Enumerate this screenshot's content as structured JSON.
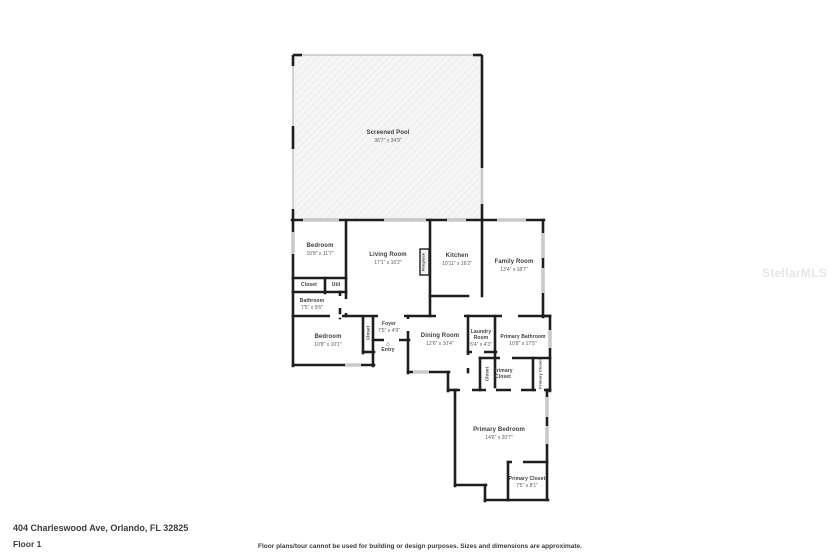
{
  "watermark": "StellarMLS",
  "footer": {
    "address": "404 Charleswood Ave, Orlando, FL 32825",
    "floor_label": "Floor 1",
    "disclaimer": "Floor plans/tour cannot be used for building or design purposes. Sizes and dimensions are approximate."
  },
  "entry_arrow": "△",
  "rooms": {
    "screened_pool": {
      "name": "Screened Pool",
      "dims": "36'7\" x 34'9\""
    },
    "bedroom1": {
      "name": "Bedroom",
      "dims": "10'8\" x 11'7\""
    },
    "living_room": {
      "name": "Living Room",
      "dims": "17'1\" x 16'2\""
    },
    "kitchen": {
      "name": "Kitchen",
      "dims": "10'11\" x 16'2\""
    },
    "family_room": {
      "name": "Family Room",
      "dims": "13'4\" x 18'7\""
    },
    "closet_hall": {
      "name": "Closet"
    },
    "util": {
      "name": "Util"
    },
    "bathroom": {
      "name": "Bathroom",
      "dims": "7'5\" x 9'6\""
    },
    "bedroom2": {
      "name": "Bedroom",
      "dims": "10'8\" x 10'1\""
    },
    "closet_bedroom2": {
      "name": "Closet"
    },
    "foyer": {
      "name": "Foyer",
      "dims": "7'5\" x 4'9\""
    },
    "entry": {
      "name": "Entry"
    },
    "dining_room": {
      "name": "Dining Room",
      "dims": "12'6\" x 10'4\""
    },
    "laundry_room": {
      "name": "Laundry Room",
      "dims": "5'4\" x 4'3\""
    },
    "primary_bathroom": {
      "name": "Primary Bathroom",
      "dims": "10'8\" x 17'5\""
    },
    "closet_hall2": {
      "name": "Closet"
    },
    "primary_closet_a": {
      "name": "Primary Closet"
    },
    "primary_closet_b": {
      "name": "Primary Closet"
    },
    "primary_bedroom": {
      "name": "Primary Bedroom",
      "dims": "14'6\" x 20'7\""
    },
    "primary_closet_c": {
      "name": "Primary Closet",
      "dims": "7'5\" x 8'1\""
    },
    "fireplace": {
      "name": "Fireplace"
    }
  }
}
